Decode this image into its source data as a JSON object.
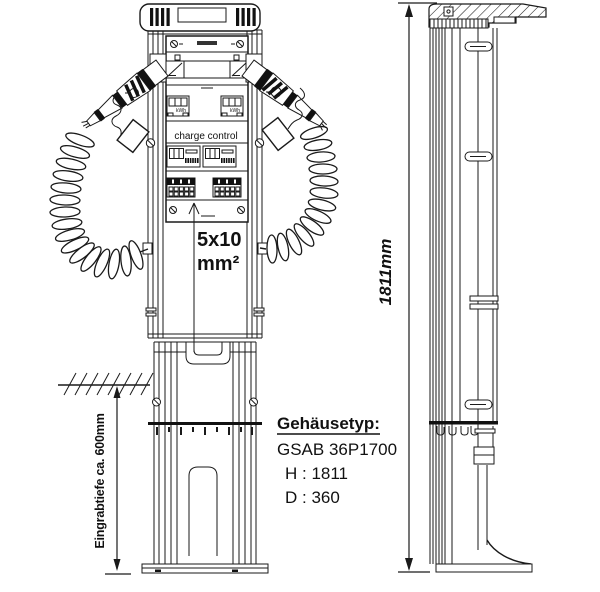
{
  "meta": {
    "background_color": "#ffffff",
    "line_color": "#1a1a1a",
    "drawing_type": "technical drawing of EV charging column, front and side view"
  },
  "front_view": {
    "charge_control_label": "charge control",
    "meter_left_label": "kWh",
    "meter_right_label": "kWh",
    "cable_spec": {
      "line1": "5x10",
      "line2": "mm²"
    },
    "burial_depth_label": "Eingrabtiefe ca. 600mm"
  },
  "side_view": {
    "height_dimension_label": "1811mm"
  },
  "spec_block": {
    "title": "Gehäusetyp:",
    "model": "GSAB 36P1700",
    "height_line": "H : 1811",
    "depth_line": "D : 360"
  }
}
